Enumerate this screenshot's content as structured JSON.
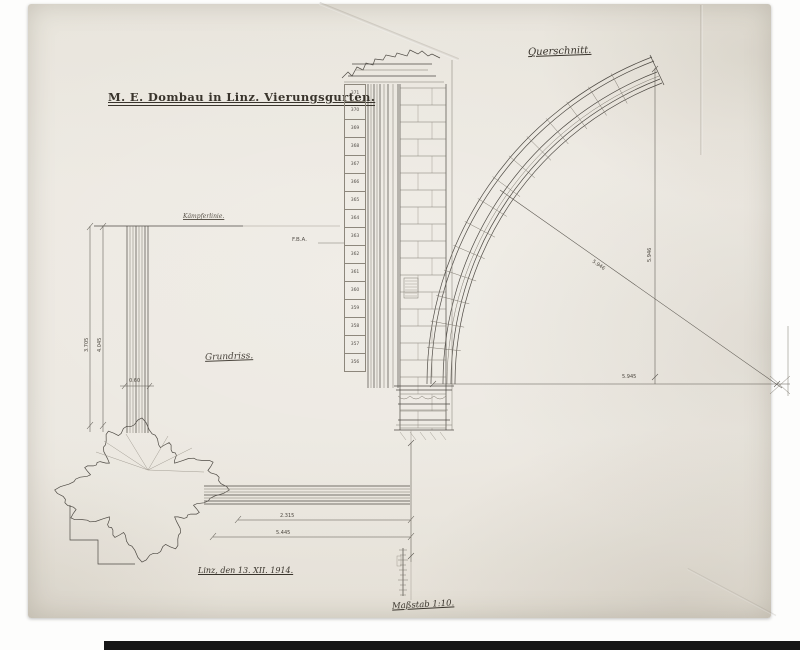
{
  "document": {
    "title": "M. E. Dombau in Linz. Vierungsgurten.",
    "labels": {
      "section": "Querschnitt.",
      "plan": "Grundriss.",
      "impost_line": "Kämpferlinie.",
      "date": "Linz, den 13. XII. 1914.",
      "signature": "Maßstab 1:10.",
      "fba": "F.B.A."
    },
    "dimensions": {
      "arch_radius_diagonal": "5.946",
      "arch_height_vertical": "5.946",
      "arch_span_horizontal": "5.945",
      "plan_span_inner": "2.315",
      "plan_span_outer": "5.445",
      "rib_width": "0.60",
      "pier_dim_left": "3.705",
      "pier_dim_right": "4.045"
    },
    "course_numbers": [
      "371",
      "370",
      "369",
      "368",
      "367",
      "366",
      "365",
      "364",
      "363",
      "362",
      "361",
      "360",
      "359",
      "358",
      "357",
      "356"
    ],
    "colors": {
      "paper": "#eae6de",
      "ink": "#4e4a44",
      "faint": "#8d877c",
      "background": "#fdfdfc"
    }
  }
}
